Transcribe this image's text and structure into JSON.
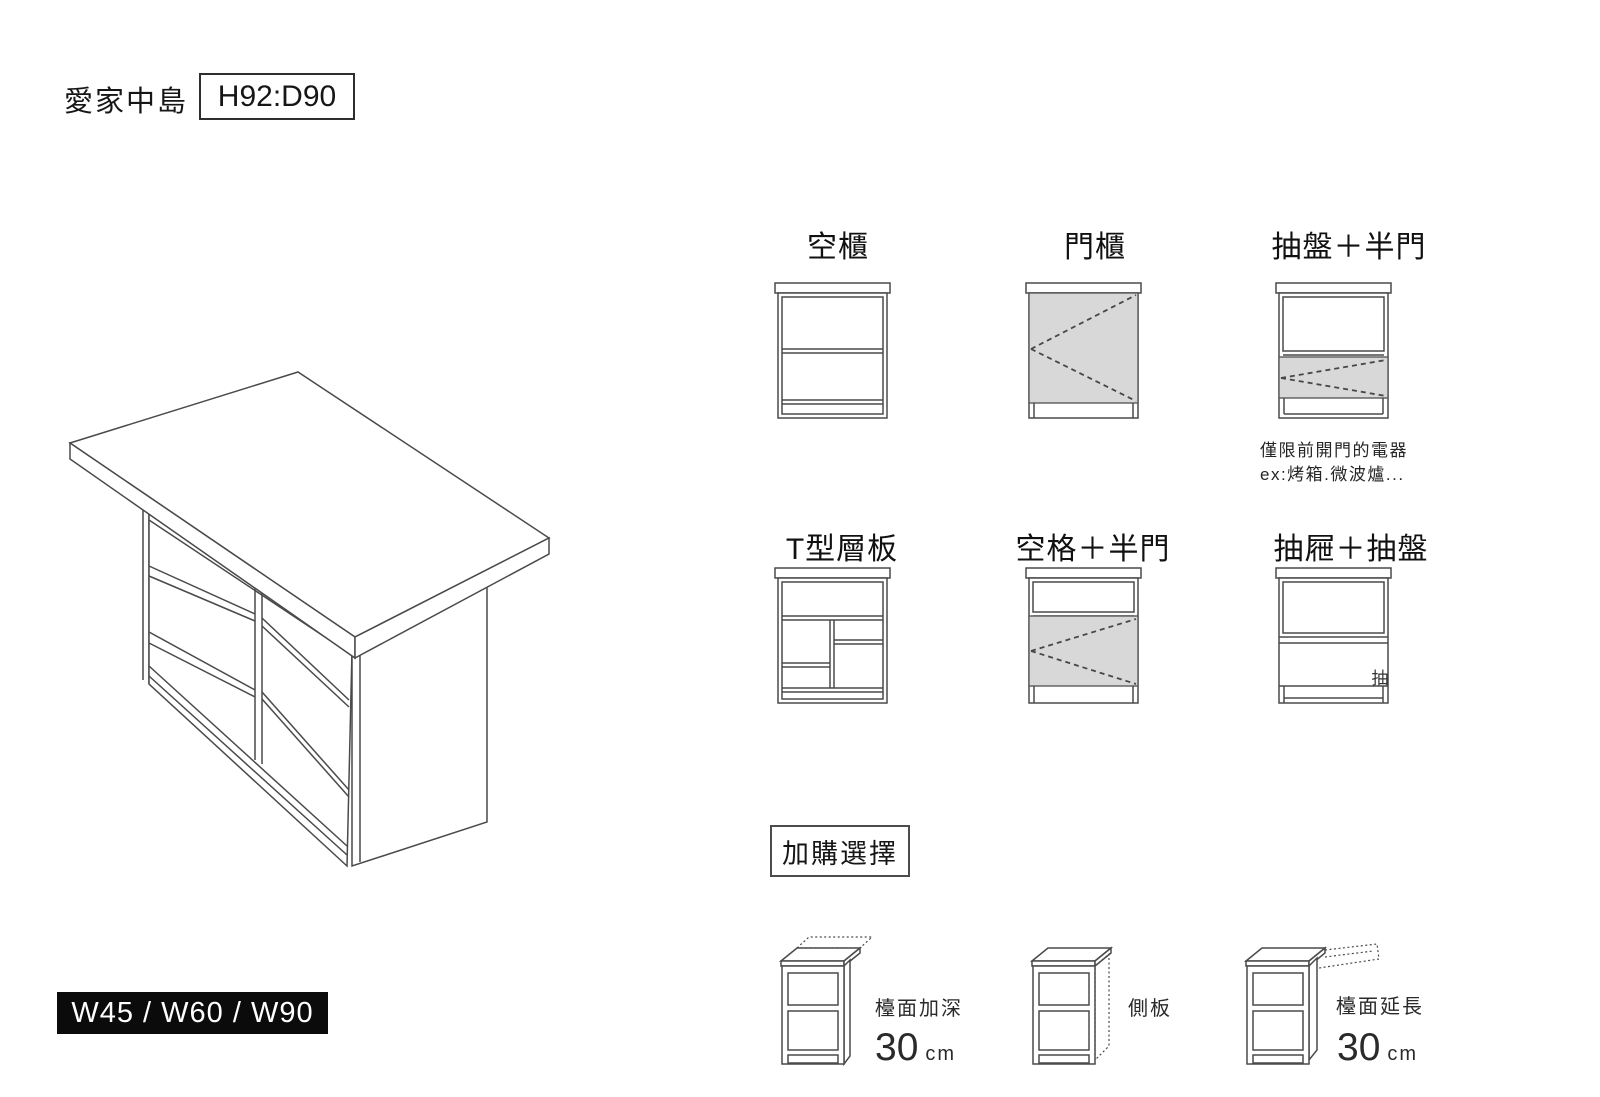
{
  "header": {
    "title": "愛家中島",
    "dimension": "H92:D90"
  },
  "island": {
    "width_options": "W45 / W60 / W90"
  },
  "options": {
    "row1": [
      {
        "label": "空櫃"
      },
      {
        "label": "門櫃"
      },
      {
        "label": "抽盤＋半門",
        "note1": "僅限前開門的電器",
        "note2": "ex:烤箱.微波爐..."
      }
    ],
    "row2": [
      {
        "label": "T型層板"
      },
      {
        "label": "空格＋半門"
      },
      {
        "label": "抽屜＋抽盤",
        "drawer_char": "抽"
      }
    ]
  },
  "addons": {
    "title": "加購選擇",
    "items": [
      {
        "label": "檯面加深",
        "value": "30",
        "unit": "cm"
      },
      {
        "label": "側板"
      },
      {
        "label": "檯面延長",
        "value": "30",
        "unit": "cm"
      }
    ]
  },
  "colors": {
    "line": "#4a4a4a",
    "gray_fill": "#d8d8d8",
    "text": "#1c1c1c",
    "badge_bg": "#0b0b0b",
    "badge_text": "#ffffff"
  }
}
